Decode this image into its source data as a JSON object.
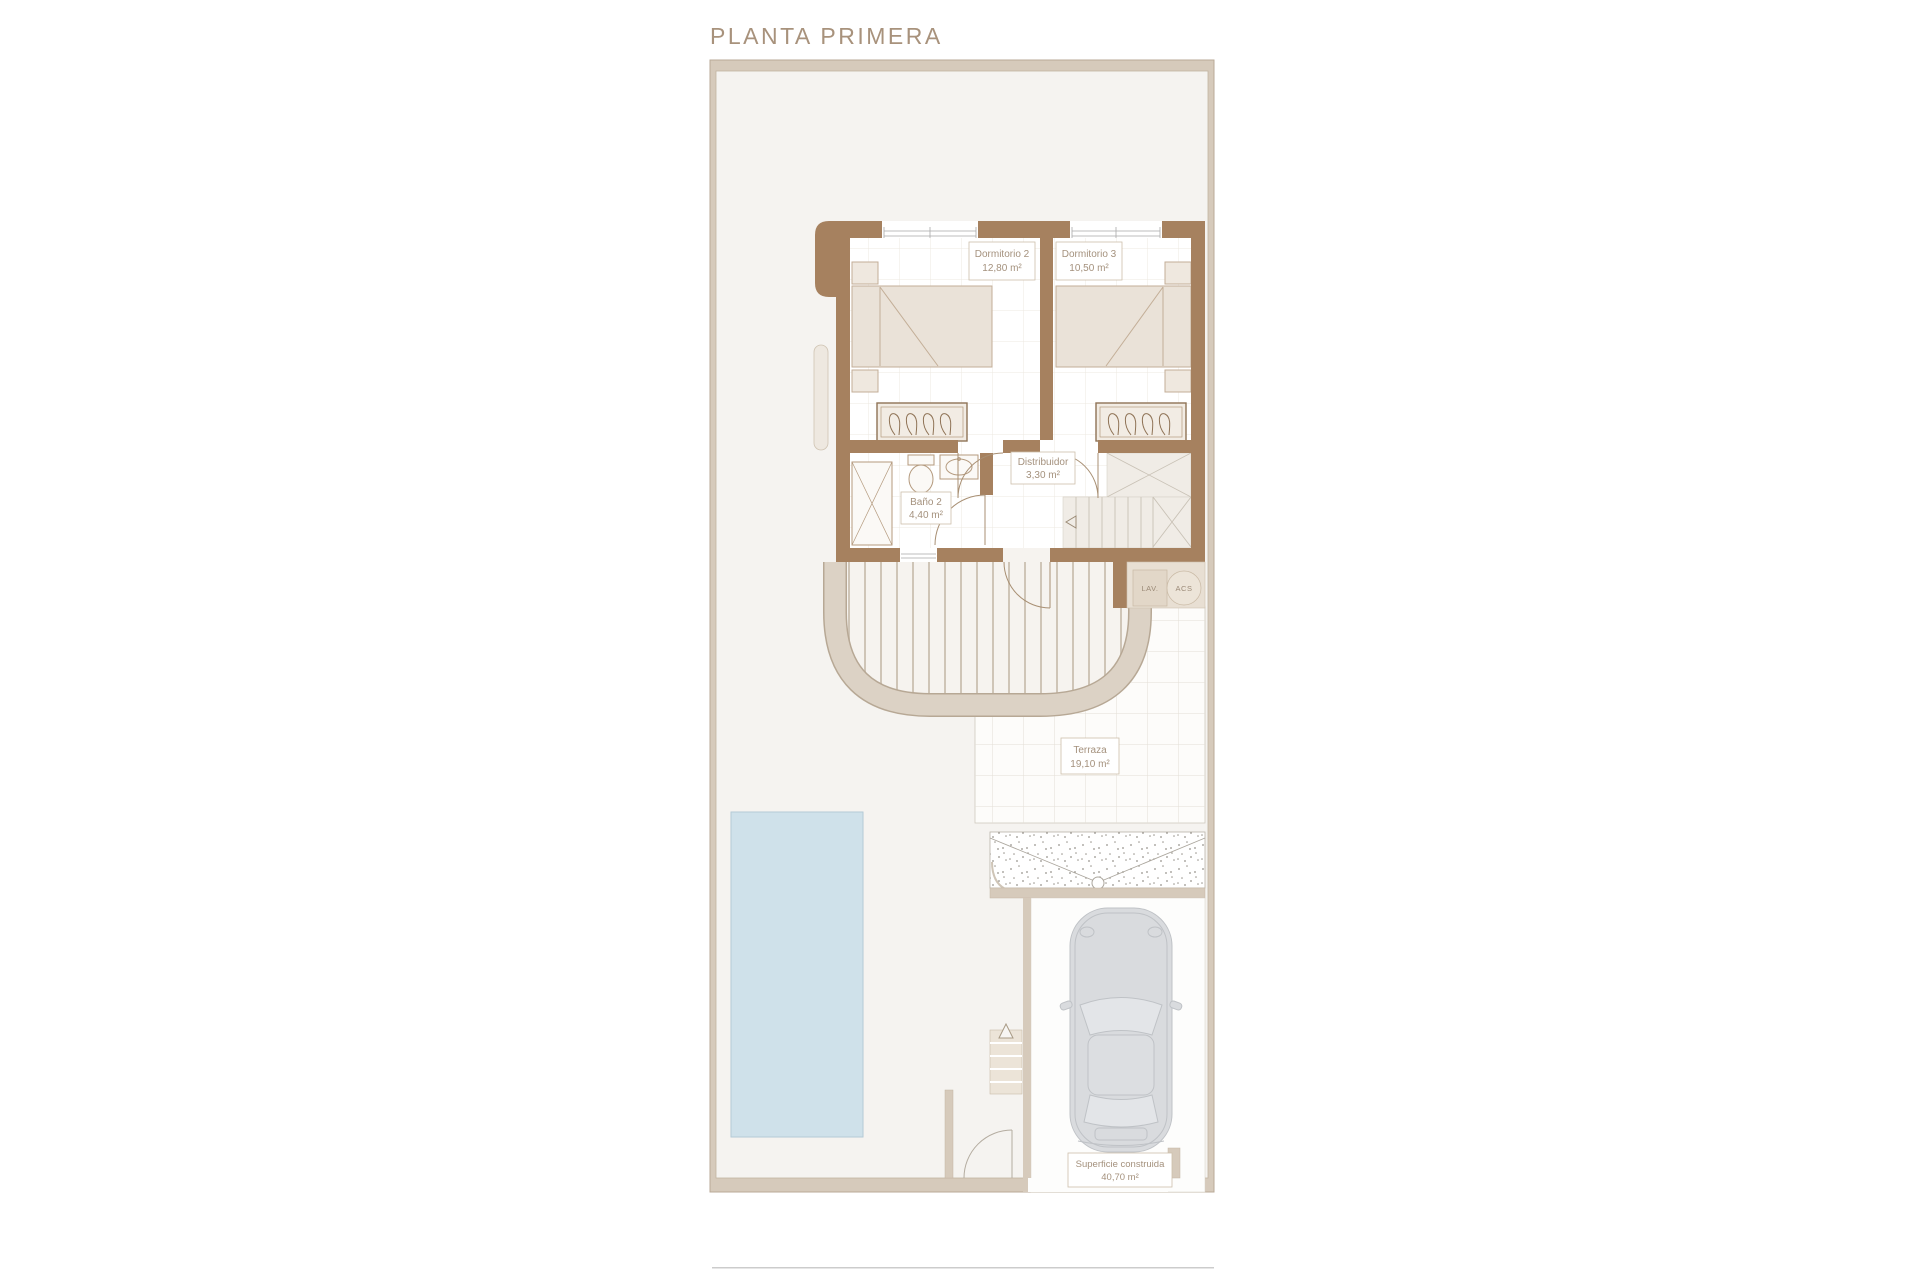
{
  "title": "PLANTA PRIMERA",
  "rooms": {
    "dormitorio2": {
      "name": "Dormitorio 2",
      "area": "12,80 m²"
    },
    "dormitorio3": {
      "name": "Dormitorio 3",
      "area": "10,50 m²"
    },
    "distribuidor": {
      "name": "Distribuidor",
      "area": "3,30 m²"
    },
    "bano2": {
      "name": "Baño 2",
      "area": "4,40 m²"
    },
    "terraza": {
      "name": "Terraza",
      "area": "19,10 m²"
    },
    "built_surface": {
      "name": "Superficie construida",
      "area": "40,70 m²"
    }
  },
  "utilities": {
    "laundry": "LAV.",
    "water_heater": "ACS"
  },
  "colors": {
    "wall_brown": "#a6815f",
    "border_beige": "#d6cabb",
    "plot_fill": "#f5f3f0",
    "pool_fill": "#cfe1ea",
    "label_text": "#a4917d",
    "furniture_fill": "#eae2d8",
    "car_gray": "#d9dbde",
    "tile_line": "#e4dfd7"
  }
}
